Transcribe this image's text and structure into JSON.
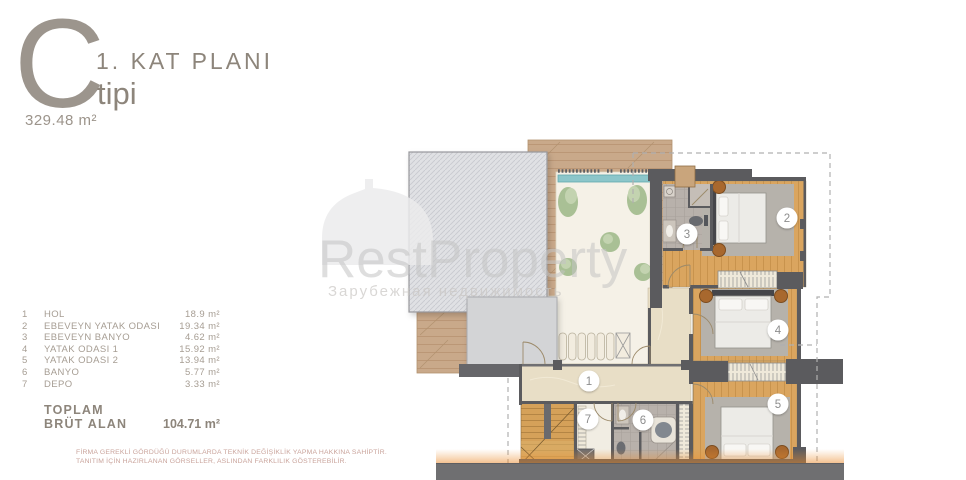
{
  "header": {
    "type_letter": "C",
    "title": "1. KAT PLANI",
    "subtitle": "tipi",
    "area": "329.48 m²"
  },
  "legend": {
    "rows": [
      {
        "num": "1",
        "name": "HOL",
        "area": "18.9 m²"
      },
      {
        "num": "2",
        "name": "EBEVEYN YATAK ODASI",
        "area": "19.34 m²"
      },
      {
        "num": "3",
        "name": "EBEVEYN BANYO",
        "area": "4.62 m²"
      },
      {
        "num": "4",
        "name": "YATAK ODASI 1",
        "area": "15.92 m²"
      },
      {
        "num": "5",
        "name": "YATAK ODASI 2",
        "area": "13.94 m²"
      },
      {
        "num": "6",
        "name": "BANYO",
        "area": "5.77 m²"
      },
      {
        "num": "7",
        "name": "DEPO",
        "area": "3.33 m²"
      }
    ],
    "total_label_line1": "TOPLAM",
    "total_label_line2": "BRÜT ALAN",
    "total_value": "104.71 m²"
  },
  "disclaimer": {
    "line1": "FİRMA GEREKLİ GÖRDÜĞÜ DURUMLARDA TEKNİK DEĞİŞİKLİK YAPMA HAKKINA SAHİPTİR.",
    "line2": "TANITIM İÇİN HAZIRLANAN GÖRSELLER, ASLINDAN FARKLILIK GÖSTEREBİLİR."
  },
  "watermark": {
    "brand": "RestProperty",
    "subtitle": "Зарубежная недвижимость"
  },
  "plan": {
    "room_markers": [
      {
        "label": "1"
      },
      {
        "label": "2"
      },
      {
        "label": "3"
      },
      {
        "label": "4"
      },
      {
        "label": "5"
      },
      {
        "label": "6"
      },
      {
        "label": "7"
      }
    ]
  },
  "colors": {
    "wood_floor": "#d9a45c",
    "wall": "#5b5b5e",
    "pool": "#8cc6ca",
    "marble": "#e8dec6",
    "roof": "#e0e1e4",
    "text_muted": "#a69d93",
    "disclaimer_text": "#c9a39b",
    "glow": "#e8913c"
  }
}
